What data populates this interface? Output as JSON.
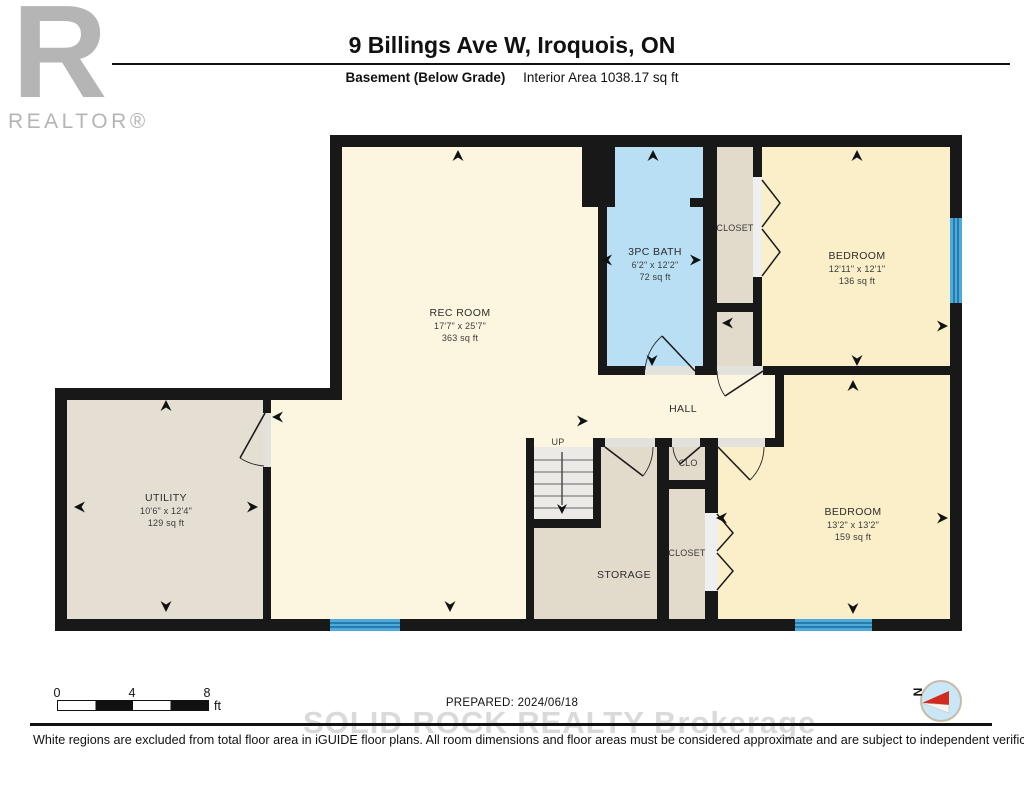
{
  "logo": {
    "letter": "R",
    "brand": "REALTOR®"
  },
  "header": {
    "title": "9 Billings Ave W, Iroquois, ON",
    "floor_label": "Basement (Below Grade)",
    "area_label": "Interior Area 1038.17 sq ft"
  },
  "rooms": {
    "rec_room": {
      "name": "REC ROOM",
      "dims": "17'7\" x 25'7\"",
      "area": "363 sq ft"
    },
    "bath": {
      "name": "3PC BATH",
      "dims": "6'2\" x 12'2\"",
      "area": "72 sq ft"
    },
    "closet_top": {
      "name": "CLOSET"
    },
    "bedroom_top": {
      "name": "BEDROOM",
      "dims": "12'11\" x 12'1\"",
      "area": "136 sq ft"
    },
    "utility": {
      "name": "UTILITY",
      "dims": "10'6\" x 12'4\"",
      "area": "129 sq ft"
    },
    "hall": {
      "name": "HALL"
    },
    "stairs": {
      "label": "UP"
    },
    "storage": {
      "name": "STORAGE"
    },
    "clo": {
      "name": "CLO"
    },
    "closet_bottom": {
      "name": "CLOSET"
    },
    "bedroom_bottom": {
      "name": "BEDROOM",
      "dims": "13'2\" x 13'2\"",
      "area": "159 sq ft"
    }
  },
  "scale_bar": {
    "ticks": [
      "0",
      "4",
      "8"
    ],
    "unit": "ft"
  },
  "compass": {
    "north_label": "N"
  },
  "footer": {
    "prepared": "PREPARED: 2024/06/18",
    "watermark": "SOLID ROCK REALTY   Brokerage",
    "disclaimer": "White regions are excluded from total floor area in iGUIDE floor plans. All room dimensions and floor areas must be considered approximate and are subject to independent verification."
  },
  "colors": {
    "wall": "#181818",
    "rec_room": "#fcf6e0",
    "bedroom": "#faefc8",
    "bath": "#b9dff5",
    "utility": "#e5ded2",
    "storage": "#e2dacb",
    "window": "#4faadc",
    "compass_red": "#d02b20"
  }
}
